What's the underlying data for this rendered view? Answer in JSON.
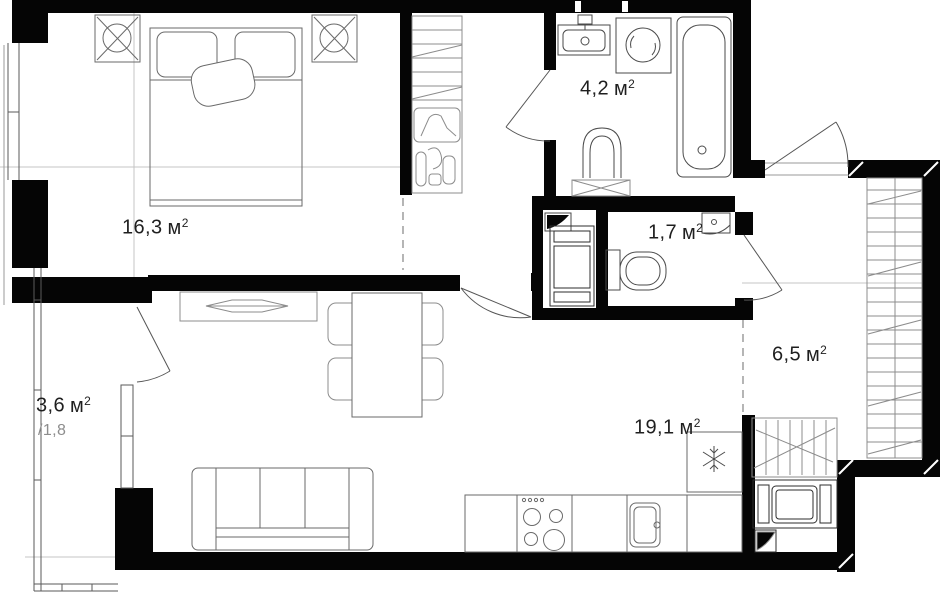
{
  "rooms": [
    {
      "id": "bedroom",
      "area": "16,3",
      "unit": "м",
      "sup": "2"
    },
    {
      "id": "bathroom",
      "area": "4,2",
      "unit": "м",
      "sup": "2"
    },
    {
      "id": "wc",
      "area": "1,7",
      "unit": "м",
      "sup": "2"
    },
    {
      "id": "hallway",
      "area": "6,5",
      "unit": "м",
      "sup": "2"
    },
    {
      "id": "living-kitchen",
      "area": "19,1",
      "unit": "м",
      "sup": "2"
    },
    {
      "id": "balcony",
      "area": "3,6",
      "unit": "м",
      "sup": "2",
      "secondary": "/1,8"
    }
  ],
  "icons": {
    "ceiling_light": "crossed-circle-in-square",
    "fridge": "snowflake",
    "ventilation_duct": "quarter-flap",
    "washing_machine": "circle-in-square"
  },
  "colors": {
    "wall": "#050505",
    "fixture_line": "#4a4a4a",
    "furniture_line": "#8c8c8c",
    "axis_line": "#c4c4c4",
    "dashed_zone_line": "#969696",
    "background": "#ffffff",
    "label_text": "#1f1f1f",
    "secondary_text": "#8d8d8d"
  }
}
